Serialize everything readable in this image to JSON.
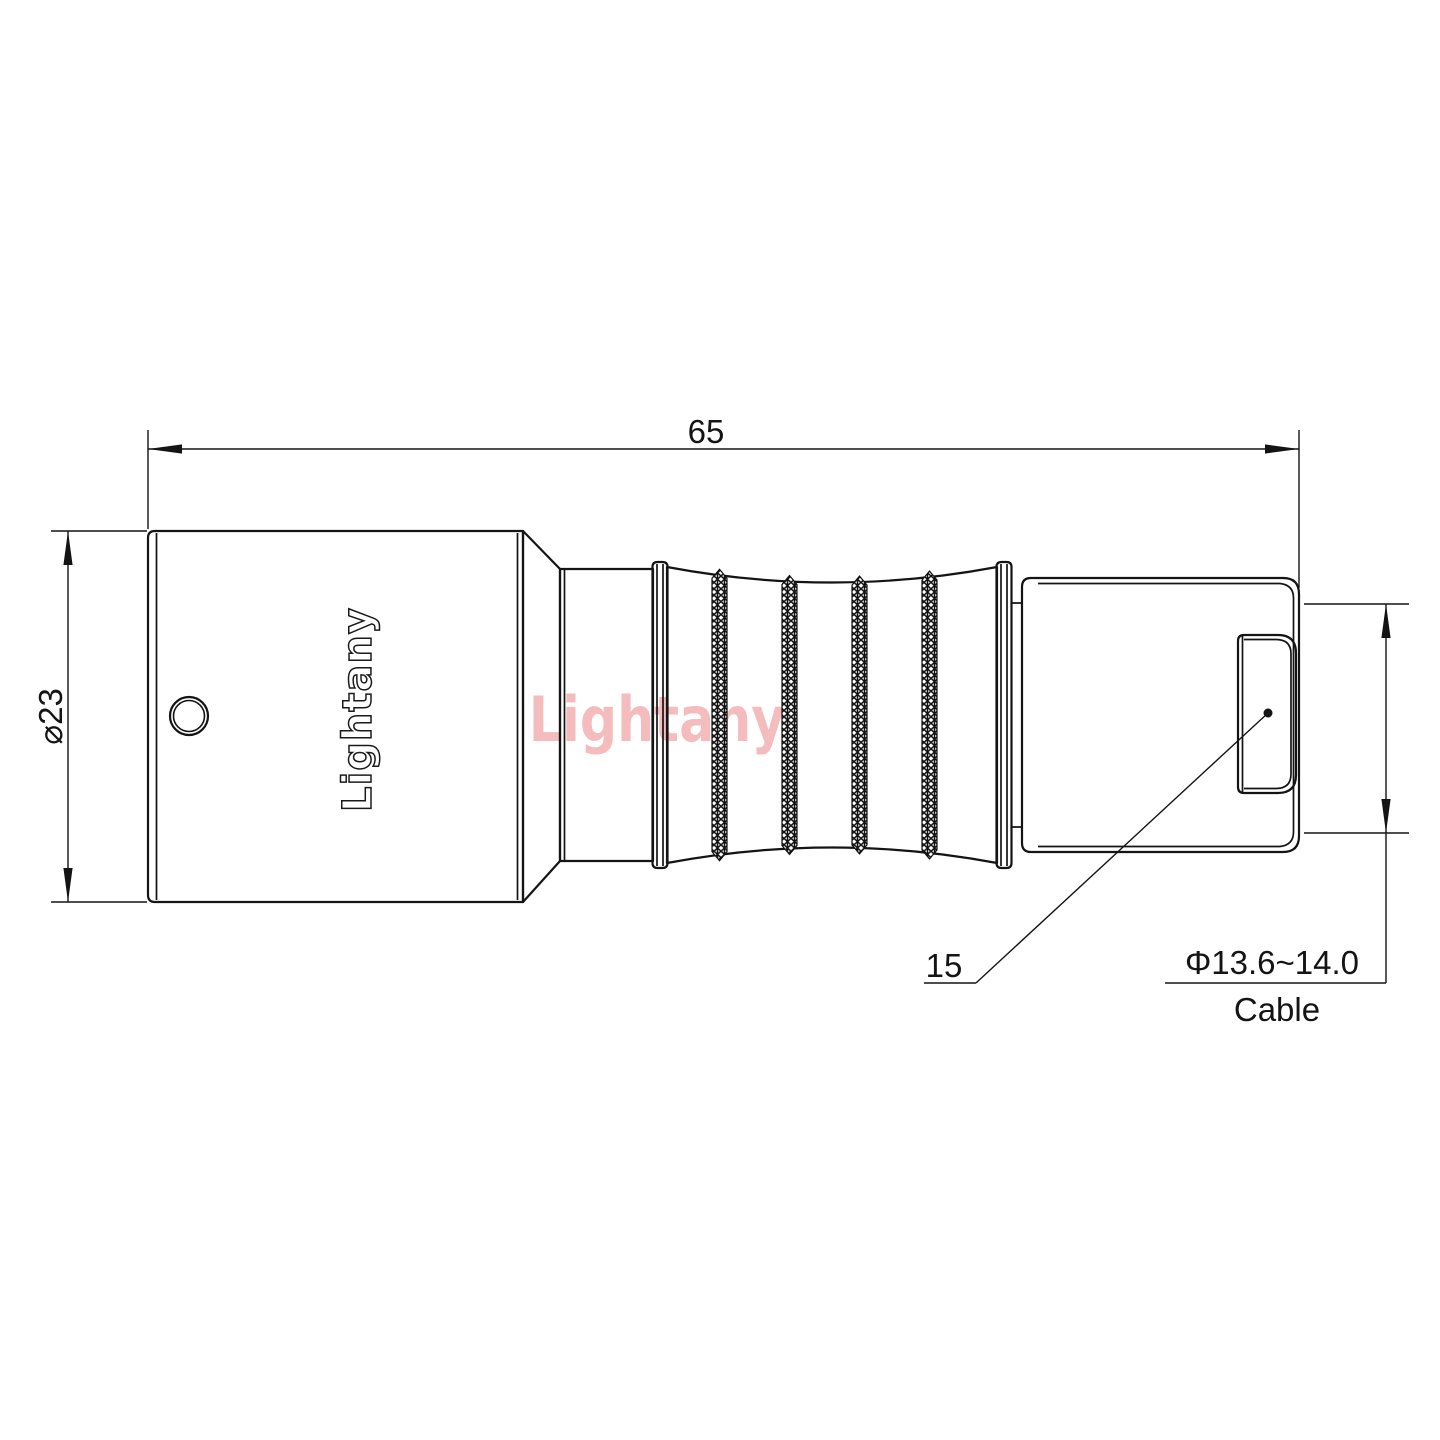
{
  "drawing": {
    "brand_logo": "Lightany",
    "watermark": "Lightany",
    "dimensions": {
      "overall_length": "65",
      "body_diameter": "⌀23",
      "rear_length": "15",
      "cable_diameter": "Φ13.6~14.0",
      "cable_label": "Cable"
    },
    "colors": {
      "line": "#141414",
      "watermark": "#f4bcbc",
      "background": "#ffffff"
    }
  }
}
